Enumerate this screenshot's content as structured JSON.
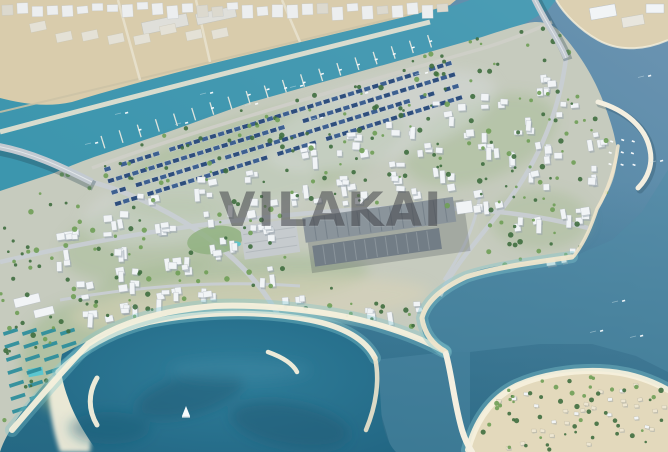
{
  "watermark": {
    "text": "VILAKAI"
  },
  "palette": {
    "waterTop": "#6D94B2",
    "waterBottom": "#2E7A96",
    "creek": "#3AA3B8",
    "creekGlint": "#7FD0DF",
    "bay": "#4F8BA6",
    "lagoonDeep": "#1D5A74",
    "shallow": "#7FC6CE",
    "sand": "#EFE6CC",
    "sandBright": "#F6F0DC",
    "mainland": "#D9CCAC",
    "mainlandRoad": "#E9E3D2",
    "mainlandRoadDark": "#CBC2A6",
    "quaySand": "#DCD0B2",
    "landBase": "#C6CBBE",
    "landGreen": "#9DB889",
    "landUrban": "#D6D9DA",
    "landSandy": "#DCD4B8",
    "road": "#C9CED3",
    "roofNavy": "#2E4E7C",
    "roofNavy2": "#3D6090",
    "building": "#F1F4F6",
    "buildingShadow": "#96A1AB",
    "treeDark": "#3F6E3F",
    "treeLight": "#6F9E56",
    "mallRoof": "#8A949B",
    "mallRoofDark": "#727D86",
    "parking": "#C6CBCE",
    "breakwater": "#F4EFE0",
    "bridge": "#C3CAD1",
    "cabana": "#2F8E9C",
    "pool": "#56C6D2",
    "boat": "#F8FBFD",
    "shed": "#DFDFDA"
  }
}
